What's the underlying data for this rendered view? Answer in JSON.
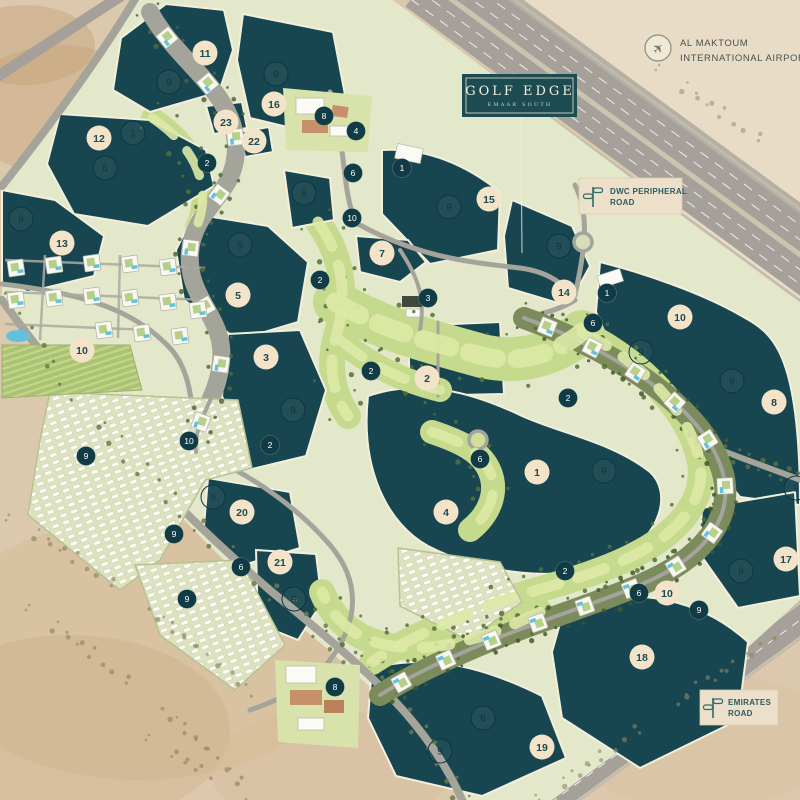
{
  "page": {
    "type": "masterplan-map",
    "project": "Golf Edge"
  },
  "sign": {
    "title": "GOLF EDGE",
    "subtitle": "EMAAR SOUTH"
  },
  "landmarks": {
    "airport": {
      "icon": "airplane-icon",
      "line1": "AL MAKTOUM",
      "line2": "INTERNATIONAL AIRPORT"
    },
    "dwc_road": {
      "icon": "signpost-icon",
      "line1": "DWC PERIPHERAL",
      "line2": "ROAD"
    },
    "emirates_road": {
      "icon": "signpost-icon",
      "line1": "EMIRATES",
      "line2": "ROAD"
    }
  },
  "colors": {
    "brand_teal": "#1D4B52",
    "lake": "#174650",
    "lake_border": "#F2EFDD",
    "sand": "#DCC9AD",
    "site_green": "#E3E8CA",
    "golf_green": "#C6DA8E",
    "road_gray": "#A5A49B",
    "marker_beige": "#F3E3C9",
    "marker_dark": "#113C46",
    "pool_blue": "#62C2DE"
  },
  "markers": {
    "plot_circles_beige": [
      {
        "n": "11",
        "x": 205,
        "y": 53
      },
      {
        "n": "16",
        "x": 274,
        "y": 104
      },
      {
        "n": "23",
        "x": 226,
        "y": 122
      },
      {
        "n": "22",
        "x": 254,
        "y": 141
      },
      {
        "n": "12",
        "x": 99,
        "y": 138
      },
      {
        "n": "13",
        "x": 62,
        "y": 243
      },
      {
        "n": "7",
        "x": 382,
        "y": 253
      },
      {
        "n": "15",
        "x": 489,
        "y": 199
      },
      {
        "n": "14",
        "x": 564,
        "y": 292
      },
      {
        "n": "5",
        "x": 238,
        "y": 295
      },
      {
        "n": "10",
        "x": 82,
        "y": 350
      },
      {
        "n": "3",
        "x": 266,
        "y": 357
      },
      {
        "n": "2",
        "x": 427,
        "y": 378
      },
      {
        "n": "10",
        "x": 680,
        "y": 317
      },
      {
        "n": "8",
        "x": 774,
        "y": 402
      },
      {
        "n": "1",
        "x": 537,
        "y": 472
      },
      {
        "n": "4",
        "x": 446,
        "y": 512
      },
      {
        "n": "20",
        "x": 242,
        "y": 512
      },
      {
        "n": "21",
        "x": 280,
        "y": 562
      },
      {
        "n": "17",
        "x": 786,
        "y": 559
      },
      {
        "n": "10",
        "x": 667,
        "y": 593
      },
      {
        "n": "18",
        "x": 642,
        "y": 657
      },
      {
        "n": "19",
        "x": 542,
        "y": 747
      }
    ],
    "lake_circles_outlined": [
      {
        "n": "9",
        "x": 169,
        "y": 82
      },
      {
        "n": "9",
        "x": 276,
        "y": 74
      },
      {
        "n": "1",
        "x": 133,
        "y": 133
      },
      {
        "n": "6",
        "x": 105,
        "y": 168
      },
      {
        "n": "9",
        "x": 21,
        "y": 219
      },
      {
        "n": "6",
        "x": 304,
        "y": 193
      },
      {
        "n": "9",
        "x": 449,
        "y": 207
      },
      {
        "n": "9",
        "x": 559,
        "y": 246
      },
      {
        "n": "9",
        "x": 240,
        "y": 245
      },
      {
        "n": "9",
        "x": 293,
        "y": 410
      },
      {
        "n": "9",
        "x": 641,
        "y": 352
      },
      {
        "n": "9",
        "x": 732,
        "y": 381
      },
      {
        "n": "9",
        "x": 604,
        "y": 471
      },
      {
        "n": "9",
        "x": 213,
        "y": 497
      },
      {
        "n": "9",
        "x": 796,
        "y": 488
      },
      {
        "n": "9",
        "x": 741,
        "y": 571
      },
      {
        "n": "9",
        "x": 294,
        "y": 599
      },
      {
        "n": "6",
        "x": 483,
        "y": 718
      },
      {
        "n": "9",
        "x": 440,
        "y": 751
      }
    ],
    "unit_circles_dark": [
      {
        "n": "8",
        "x": 324,
        "y": 116
      },
      {
        "n": "4",
        "x": 356,
        "y": 131
      },
      {
        "n": "2",
        "x": 207,
        "y": 163
      },
      {
        "n": "6",
        "x": 353,
        "y": 173
      },
      {
        "n": "1",
        "x": 402,
        "y": 168
      },
      {
        "n": "10",
        "x": 352,
        "y": 218
      },
      {
        "n": "2",
        "x": 320,
        "y": 280
      },
      {
        "n": "1",
        "x": 607,
        "y": 293
      },
      {
        "n": "3",
        "x": 428,
        "y": 298
      },
      {
        "n": "6",
        "x": 593,
        "y": 323
      },
      {
        "n": "2",
        "x": 371,
        "y": 371
      },
      {
        "n": "2",
        "x": 568,
        "y": 398
      },
      {
        "n": "10",
        "x": 189,
        "y": 441
      },
      {
        "n": "2",
        "x": 270,
        "y": 445
      },
      {
        "n": "9",
        "x": 86,
        "y": 456
      },
      {
        "n": "6",
        "x": 480,
        "y": 459
      },
      {
        "n": "9",
        "x": 174,
        "y": 534
      },
      {
        "n": "2",
        "x": 565,
        "y": 571
      },
      {
        "n": "6",
        "x": 241,
        "y": 567
      },
      {
        "n": "9",
        "x": 187,
        "y": 599
      },
      {
        "n": "6",
        "x": 639,
        "y": 593
      },
      {
        "n": "9",
        "x": 699,
        "y": 610
      },
      {
        "n": "8",
        "x": 335,
        "y": 687
      }
    ]
  }
}
